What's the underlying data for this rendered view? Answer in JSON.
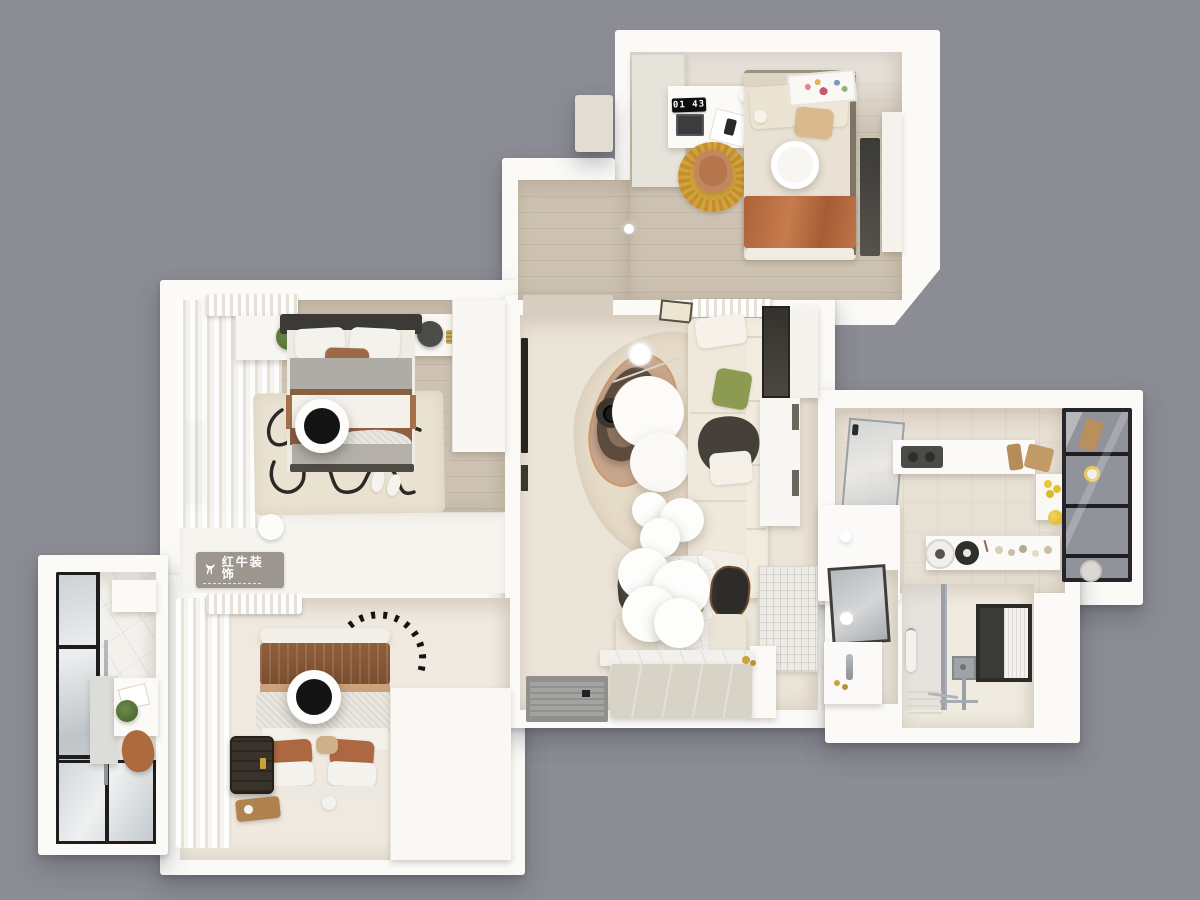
{
  "watermark": {
    "brand_text": "红牛装饰",
    "logo_icon": "bull-icon"
  },
  "rooms": {
    "bedroom_top": {
      "label": "bedroom-top-right",
      "clock_display": "01 43",
      "furniture": [
        "wardrobe",
        "desk",
        "led-clock",
        "laptop",
        "notebook",
        "desk-lamp",
        "round-yellow-rug",
        "desk-chair",
        "double-bed",
        "terracotta-throw",
        "wall-art",
        "ceiling-lamp",
        "window",
        "mirror-panel"
      ]
    },
    "bedroom_master": {
      "label": "bedroom-master",
      "furniture": [
        "air-conditioner",
        "curtains",
        "window",
        "nightstand-plant",
        "nightstand-lamp",
        "double-bed",
        "gray-bedding",
        "squiggle-rug",
        "slippers",
        "ceiling-fan-lamp",
        "wardrobe",
        "humidifier",
        "low-cabinet"
      ]
    },
    "bedroom_second": {
      "label": "bedroom-second",
      "furniture": [
        "air-conditioner",
        "curtains",
        "dashed-arc-decor",
        "double-bed",
        "brown-quilt",
        "knit-blanket",
        "terracotta-pillows",
        "ceiling-fan-lamp",
        "suitcase",
        "floor-tray",
        "stool",
        "wardrobe-block"
      ]
    },
    "balcony": {
      "label": "balcony",
      "furniture": [
        "glazed-wall",
        "drying-pole",
        "panel",
        "desk",
        "papers",
        "plant",
        "saddle-chair",
        "marble-floor"
      ]
    },
    "living_dining": {
      "label": "living-dining-room",
      "furniture": [
        "wall-tv",
        "air-conditioner",
        "leaning-art",
        "organic-rug",
        "accent-chair",
        "round-coffee-tables",
        "tea-tray",
        "arc-floor-lamp",
        "l-shaped-sofa",
        "green-pillow",
        "dark-throw",
        "window",
        "side-cabinet",
        "cloud-pendant-lamps",
        "marble-dining-table",
        "dining-chairs",
        "bench",
        "textured-glass-partition",
        "shoe-cabinet",
        "entry-doormat"
      ]
    },
    "kitchen": {
      "label": "kitchen",
      "furniture": [
        "glass-sliding-door",
        "counter",
        "cooktop",
        "cutting-boards",
        "spice-shelf",
        "lemons",
        "glass-fridge-cabinet",
        "kettle",
        "pot",
        "jars",
        "island-counter",
        "ceiling-spot"
      ]
    },
    "bathroom": {
      "label": "bathroom",
      "furniture": [
        "leaning-mirror",
        "sphere-lamp",
        "vanity-sink",
        "faucet",
        "glass-shower-partition",
        "towel",
        "shower-mixer",
        "pipes",
        "floor-drain",
        "blinded-window"
      ]
    }
  },
  "colors": {
    "bg": "#8c8c94",
    "wall": "#fbfaf7",
    "wood": "#cdc2b2",
    "cream": "#ebe4d8",
    "soft": "#efe9df",
    "tile": "#e7e0d4",
    "marble": "#f3f1ec",
    "terracotta": "#b96f45",
    "quilt-brown": "#8a5a39",
    "tan": "#caa27c",
    "rug-yellow": "#d4a23c",
    "rug-yellow2": "#c08f2e",
    "green-pillow": "#8c9a52",
    "plant-green": "#57743c",
    "dark": "#2b2a28",
    "gray-bedding": "#aeaca7",
    "glass-frame": "#1d1d1d",
    "chrome": "#9aa0a5",
    "mat-gray": "#a3a3a1",
    "cabinet-beige": "#d8d3c7",
    "watermark-bg": "rgba(146,140,132,0.9)"
  }
}
